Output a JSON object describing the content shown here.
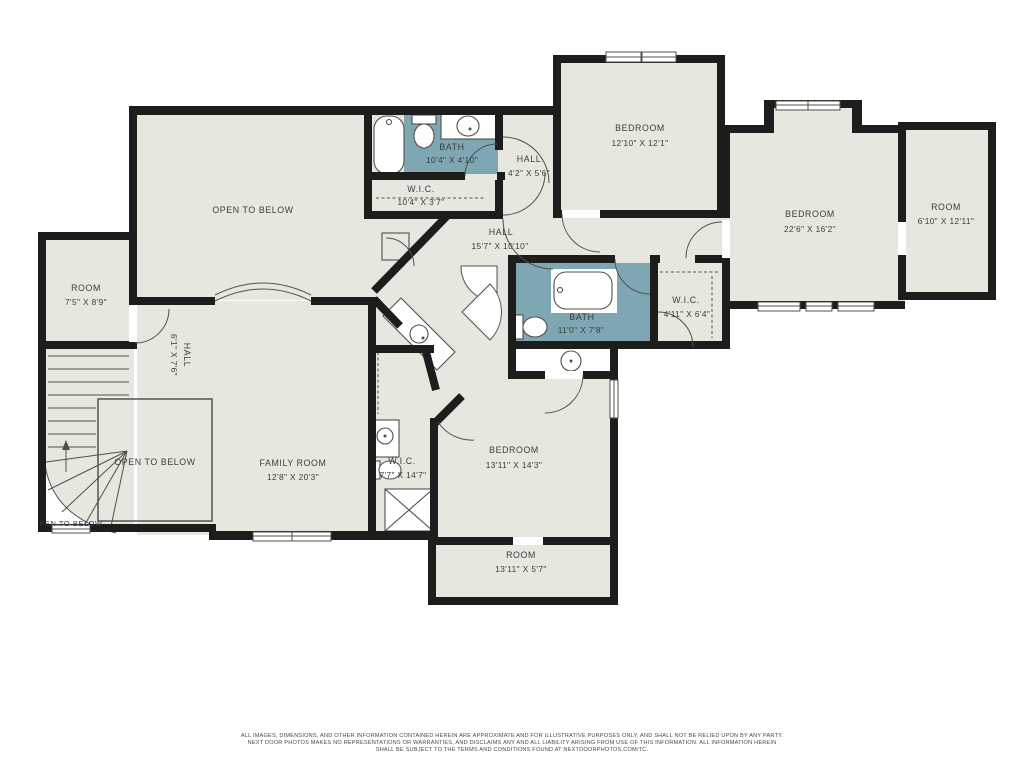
{
  "palette": {
    "wall": "#1d1d1b",
    "floor": "#e8e7df",
    "bath": "#7fa6b3",
    "line": "#50504a",
    "text": "#3c3c3b"
  },
  "rooms": [
    {
      "label": "OPEN TO BELOW",
      "dims": ""
    },
    {
      "label": "BATH",
      "dims": "10'4\" X 4'10\""
    },
    {
      "label": "W.I.C.",
      "dims": "10'4\" X 3'7\""
    },
    {
      "label": "HALL",
      "dims": "4'2\" X 5'6\""
    },
    {
      "label": "BEDROOM",
      "dims": "12'10\" X 12'1\""
    },
    {
      "label": "BEDROOM",
      "dims": "22'6\" X 16'2\""
    },
    {
      "label": "ROOM",
      "dims": "6'10\" X 12'11\""
    },
    {
      "label": "HALL",
      "dims": "15'7\" X 10'10\""
    },
    {
      "label": "BATH",
      "dims": "11'0\" X 7'8\""
    },
    {
      "label": "W.I.C.",
      "dims": "4'11\" X 6'4\""
    },
    {
      "label": "ROOM",
      "dims": "7'5\" X 8'9\""
    },
    {
      "label": "HALL",
      "dims": "6'1\" X 7'6\""
    },
    {
      "label": "OPEN TO BELOW",
      "dims": ""
    },
    {
      "label": "FAMILY ROOM",
      "dims": "12'8\" X 20'3\""
    },
    {
      "label": "W.I.C.",
      "dims": "7'7\" X 14'7\""
    },
    {
      "label": "BEDROOM",
      "dims": "13'11\" X 14'3\""
    },
    {
      "label": "ROOM",
      "dims": "13'11\" X 5'7\""
    },
    {
      "label": "PEN TO BELOW",
      "dims": ""
    }
  ],
  "footer": {
    "line1": "ALL IMAGES, DIMENSIONS, AND OTHER INFORMATION CONTAINED HEREIN ARE APPROXIMATE AND FOR ILLUSTRATIVE PURPOSES ONLY, AND SHALL NOT BE RELIED UPON BY ANY PARTY.",
    "line2": "NEXT DOOR PHOTOS MAKES NO REPRESENTATIONS OR WARRANTIES, AND DISCLAIMS ANY AND ALL LIABILITY ARISING FROM USE OF THIS INFORMATION. ALL INFORMATION HEREIN",
    "line3": "SHALL BE SUBJECT TO THE TERMS AND CONDITIONS FOUND AT NEXTDOORPHOTOS.COM/TC."
  }
}
